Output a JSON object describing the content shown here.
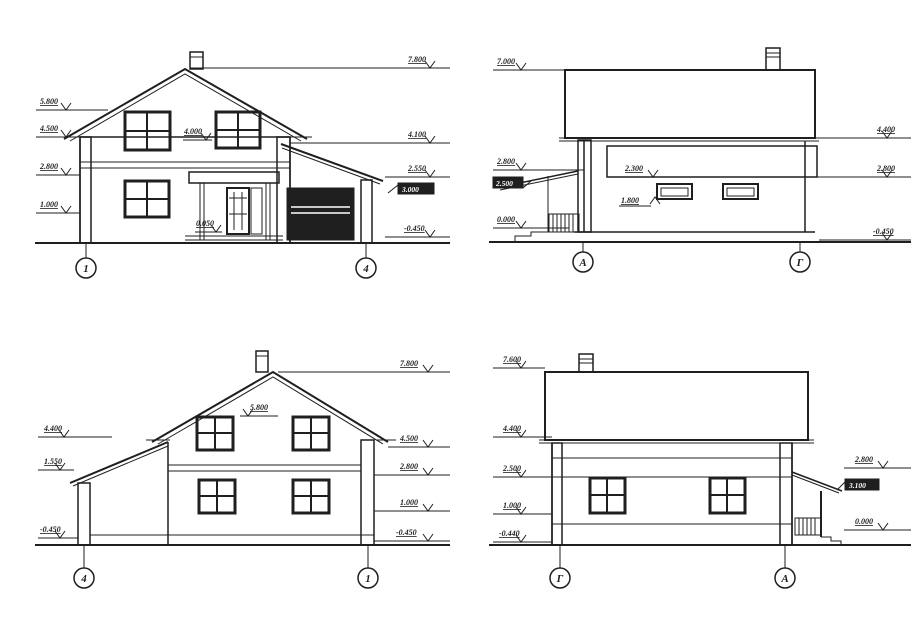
{
  "sheet": {
    "background": "#ffffff",
    "ink": "#1f1f1f"
  },
  "elevations": {
    "front": {
      "name": "front-elevation-1-4",
      "axes": {
        "left": "1",
        "right": "4"
      },
      "marks": {
        "l0": "5.800",
        "l1": "4.500",
        "l2": "2.800",
        "l3": "1.000",
        "r0": "7.800",
        "r1": "4.100",
        "r2": "2.550",
        "r3": "-0.450",
        "badge": "3.000",
        "i0": "4.000",
        "i1": "0.050"
      }
    },
    "side_ag": {
      "name": "side-elevation-a-g",
      "axes": {
        "left": "А",
        "right": "Г"
      },
      "marks": {
        "l0": "7.000",
        "l1": "2.800",
        "l2": "0.000",
        "badge": "2.500",
        "r0": "4.400",
        "r1": "2.800",
        "r2": "-0.450",
        "i0": "2.300",
        "i1": "1.800"
      }
    },
    "rear": {
      "name": "rear-elevation-4-1",
      "axes": {
        "left": "4",
        "right": "1"
      },
      "marks": {
        "l0": "4.400",
        "l1": "1.550",
        "l2": "-0.450",
        "r0": "7.800",
        "r1": "4.500",
        "r2": "2.800",
        "r3": "1.000",
        "r4": "-0.450",
        "i0": "5.800"
      }
    },
    "side_ga": {
      "name": "side-elevation-g-a",
      "axes": {
        "left": "Г",
        "right": "А"
      },
      "marks": {
        "l0": "7.600",
        "l1": "4.400",
        "l2": "2.500",
        "l3": "1.000",
        "l4": "-0.440",
        "r0": "2.800",
        "r1": "0.000",
        "badge": "3.100"
      }
    }
  }
}
